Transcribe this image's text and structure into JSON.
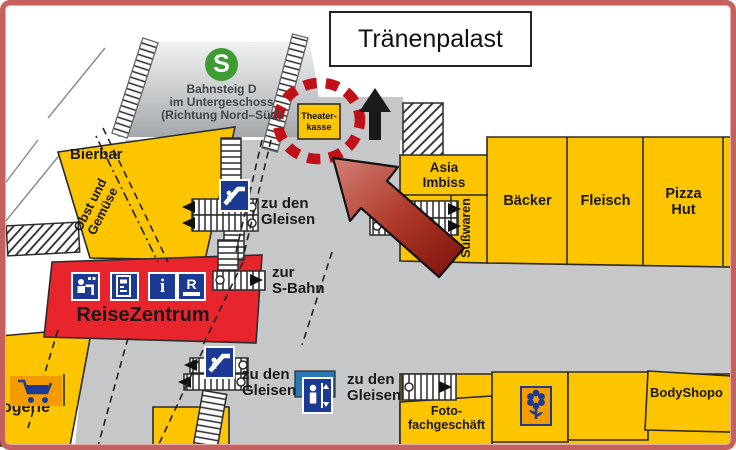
{
  "annotation": {
    "title": "Tränenpalast"
  },
  "platform": {
    "logo": "S",
    "line1": "Bahnsteig D",
    "line2": "im Untergeschoss",
    "line3": "(Richtung Nord–Süd)"
  },
  "highlight": {
    "line1": "Theater-",
    "line2": "kasse"
  },
  "shops": {
    "bierbar": "Bierbar",
    "obst_line1": "Obst und",
    "obst_line2": "Gemüse",
    "asia_line1": "Asia",
    "asia_line2": "Imbiss",
    "suesswaren": "Süßwaren",
    "baecker": "Bäcker",
    "fleisch": "Fleisch",
    "pizza_line1": "Pizza",
    "pizza_line2": "Hut",
    "bodyshop": "BodyShopo",
    "foto_line1": "Foto-",
    "foto_line2": "fachgeschäft",
    "drogerie_partial": "ogerie"
  },
  "services": {
    "reisezentrum": "ReiseZentrum",
    "info_label": "i",
    "reservation_label": "R"
  },
  "wayfinding": {
    "to_tracks_line1": "zu den",
    "to_tracks_line2": "Gleisen",
    "to_sbahn_line1": "zur",
    "to_sbahn_line2": "S-Bahn"
  },
  "colors": {
    "frame": "#c4605d",
    "yellow": "#fcc500",
    "gray": "#c6c7c9",
    "red": "#e8242c",
    "navy": "#1c3a94",
    "green": "#3f9c35",
    "orange": "#f49b00",
    "teal": "#2878b6",
    "highlight": "#c01018",
    "ink": "#1a1a1a"
  }
}
